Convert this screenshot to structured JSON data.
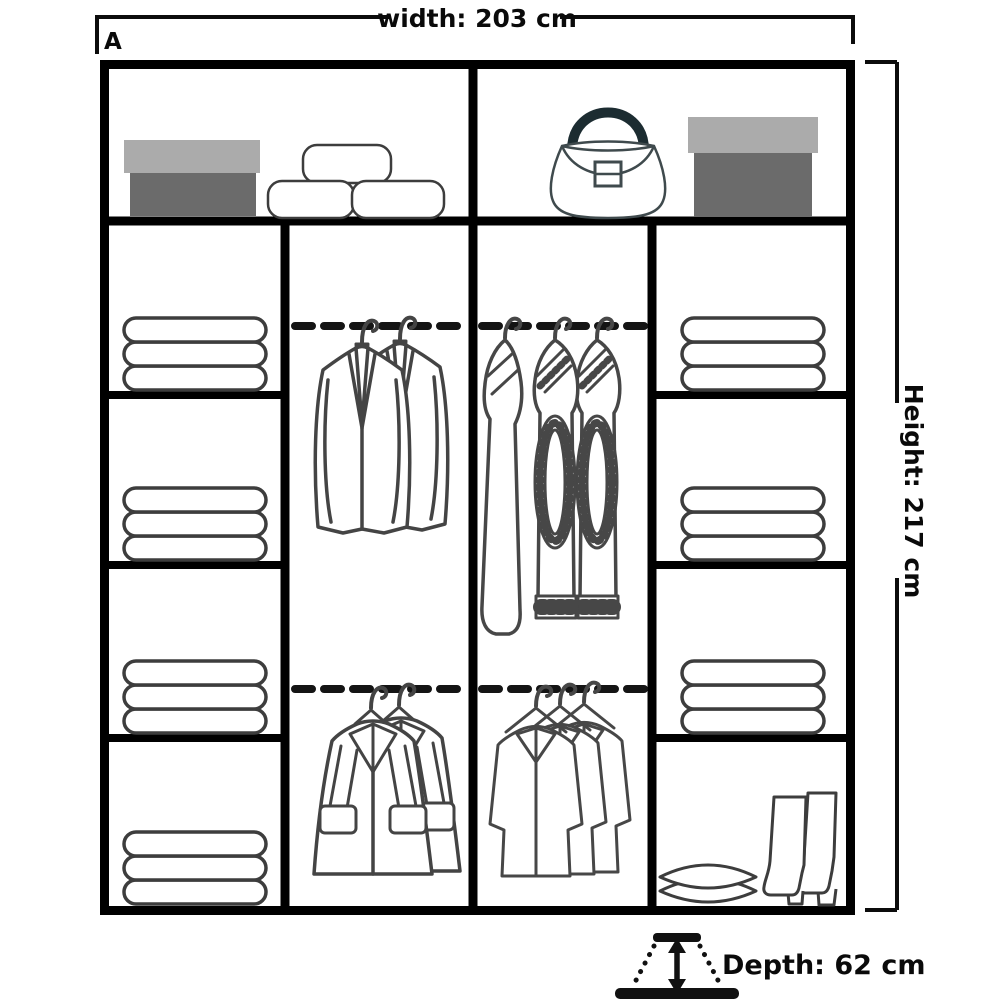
{
  "labels": {
    "variant": "A",
    "width": "width: 203 cm",
    "height": "Height: 217 cm",
    "depth": "Depth: 62 cm"
  },
  "dimensions": {
    "width_cm": 203,
    "height_cm": 217,
    "depth_cm": 62
  },
  "contents": {
    "top_shelf_left": [
      "shoebox",
      "three hat boxes"
    ],
    "top_shelf_right": [
      "handbag",
      "storage box"
    ],
    "left_shelves": [
      "folded towels",
      "folded towels",
      "folded towels",
      "folded towels"
    ],
    "center_left_top_rail": "two suit jackets on hangers",
    "center_left_bottom_rail": "two coats on hangers",
    "center_right_top_rail": "three knit garments on hangers",
    "center_right_bottom_rail": "three shirts on hangers",
    "right_shelves": [
      "folded towels",
      "folded towels",
      "folded towels",
      "pillows and boots"
    ]
  },
  "colors": {
    "frame": "#000000",
    "dimension_line": "#0c0c0c",
    "item_outline": "#3f3f3f",
    "box_lid": "#ababab",
    "box_body": "#6b6b6b",
    "bag_handle": "#1c2c31",
    "background": "#ffffff"
  }
}
